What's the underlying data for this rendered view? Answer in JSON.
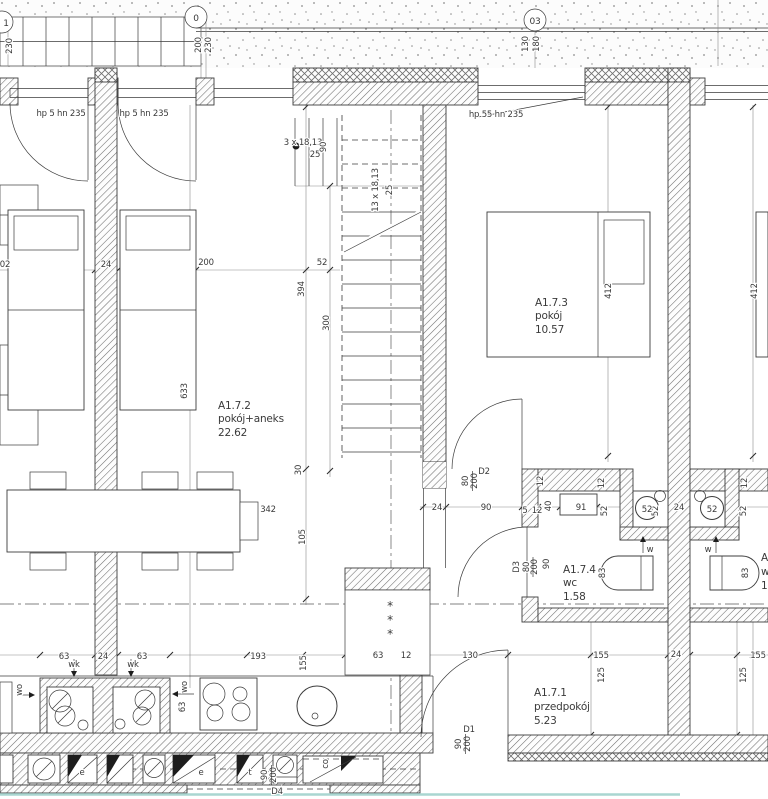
{
  "drawing": {
    "type": "architectural floor plan",
    "unit": "A1.7"
  },
  "colors": {
    "accent_teal": "#a9d6d1"
  },
  "grid_bubbles": {
    "b1": "1",
    "b2": "0",
    "b3": "03"
  },
  "rooms": {
    "przedpokoj": {
      "id": "A1.7.1",
      "name": "przedpokój",
      "area": "5.23"
    },
    "pokoj_aneks": {
      "id": "A1.7.2",
      "name": "pokój+aneks",
      "area": "22.62"
    },
    "pokoj": {
      "id": "A1.7.3",
      "name": "pokój",
      "area": "10.57"
    },
    "wc": {
      "id": "A1.7.4",
      "name": "wc",
      "area": "1.58"
    }
  },
  "windows": {
    "balcony_left": "hp 5 hn 235",
    "balcony_mid": "hp 5 hn 235",
    "bedroom": "hp 55 hn 235"
  },
  "doors": {
    "d1": {
      "id": "D1",
      "w": "90",
      "h": "200"
    },
    "d2": {
      "id": "D2",
      "w": "80",
      "h": "200"
    },
    "d3": {
      "id": "D3",
      "w": "80",
      "h": "200",
      "extra": "90"
    },
    "d4": {
      "id": "D4",
      "w": "90",
      "h": "200"
    }
  },
  "stairs": {
    "upper_run": "3 x 18,13",
    "lower_run": "13 x 18,13",
    "width": "90",
    "tread": "25"
  },
  "shaft_labels": {
    "w": "w",
    "wk": "wk",
    "wo": "wo",
    "co": "co"
  },
  "meters": {
    "e": "e",
    "t": "t"
  },
  "dims": {
    "d02": "02",
    "d5": "5",
    "d12": "12",
    "d24": "24",
    "d25": "25",
    "d30": "30",
    "d40": "40",
    "d52": "52",
    "d63": "63",
    "d83": "83",
    "d90": "90",
    "d91": "91",
    "d105": "105",
    "d125": "125",
    "d130": "130",
    "d155": "155",
    "d180": "180",
    "d193": "193",
    "d200": "200",
    "d230": "230",
    "d300": "300",
    "d342": "342",
    "d394": "394",
    "d412": "412",
    "d633": "633"
  }
}
